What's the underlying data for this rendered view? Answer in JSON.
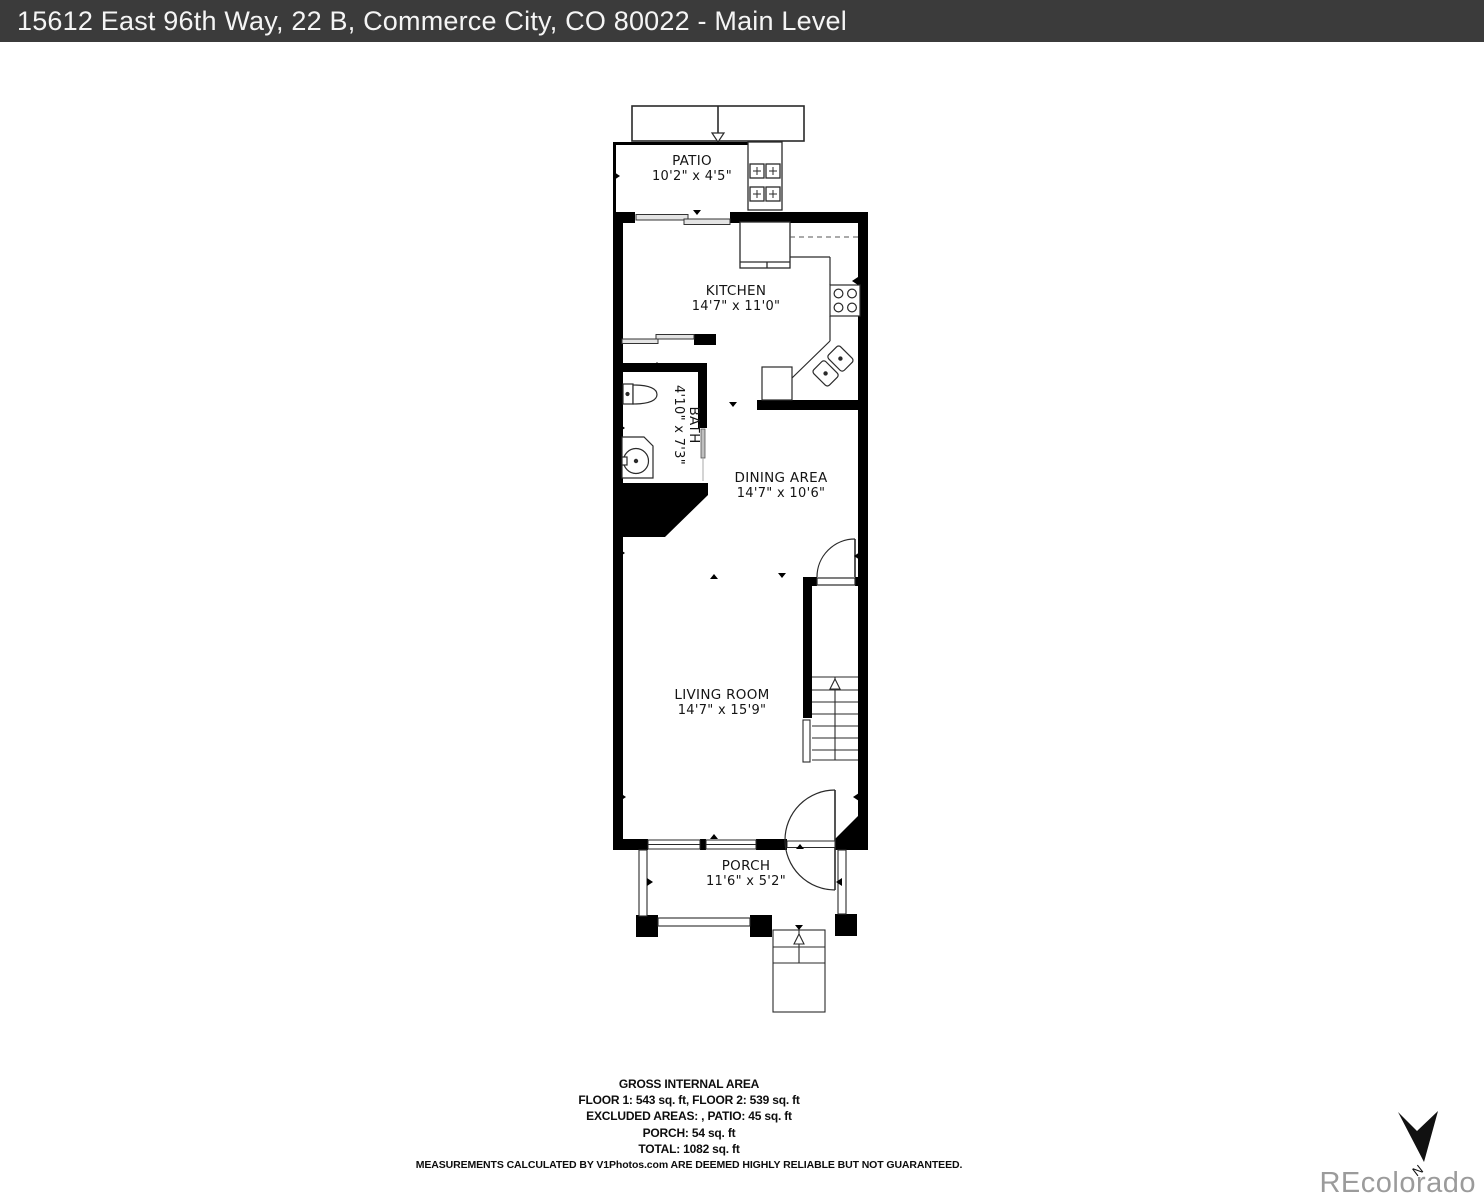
{
  "header": {
    "title": "15612 East 96th Way, 22 B, Commerce City, CO 80022 - Main Level"
  },
  "rooms": {
    "patio": {
      "name": "PATIO",
      "dims": "10'2\" x 4'5\""
    },
    "kitchen": {
      "name": "KITCHEN",
      "dims": "14'7\" x 11'0\""
    },
    "bath": {
      "name": "BATH",
      "dims": "4'10\" x 7'3\""
    },
    "dining": {
      "name": "DINING AREA",
      "dims": "14'7\" x 10'6\""
    },
    "living": {
      "name": "LIVING ROOM",
      "dims": "14'7\" x 15'9\""
    },
    "porch": {
      "name": "PORCH",
      "dims": "11'6\" x 5'2\""
    }
  },
  "footer": {
    "title": "GROSS INTERNAL AREA",
    "floors_line": "FLOOR 1: 543 sq. ft, FLOOR 2: 539 sq. ft",
    "excluded_line": "EXCLUDED AREAS: , PATIO: 45 sq. ft",
    "porch_line": "PORCH: 54 sq. ft",
    "total_line": "TOTAL: 1082 sq. ft",
    "disclaimer": "MEASUREMENTS CALCULATED BY V1Photos.com ARE DEEMED HIGHLY RELIABLE BUT NOT GUARANTEED."
  },
  "compass": {
    "label": "N"
  },
  "watermark": {
    "text": "REcolorado"
  },
  "colors": {
    "header_bg": "#3b3b3b",
    "header_text": "#f5f5f5",
    "wall": "#000000",
    "line": "#1a1a1a",
    "watermark": "#9b9b9b"
  }
}
